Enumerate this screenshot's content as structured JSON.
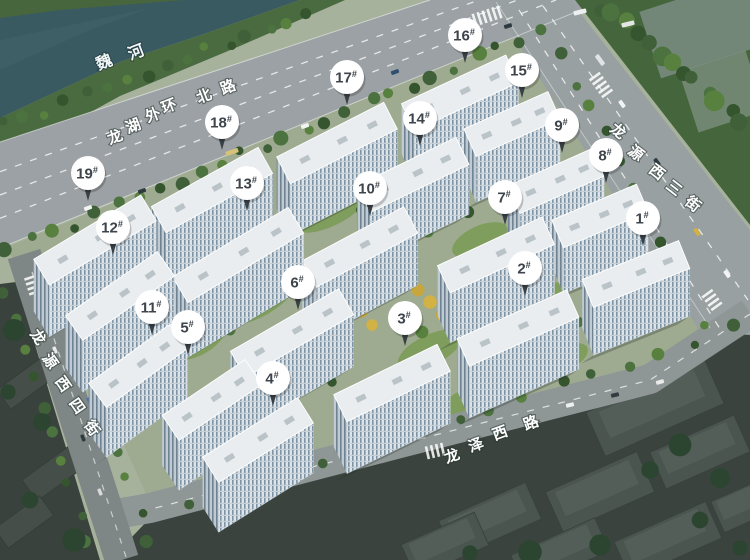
{
  "scene": {
    "type": "aerial-residential-site-plan",
    "width": 750,
    "height": 560
  },
  "palette": {
    "river": "#3a5a62",
    "road": "#9aa1a4",
    "site_ground": "#9fab91",
    "lawn": "#7c9b58",
    "tree_dark": "#3f6038",
    "tree_gold": "#d2b145",
    "building_roof": "#e9edef",
    "building_facade": "#8ea3b2",
    "marker_bg": "#ffffff",
    "marker_text": "#3d444b",
    "marker_tail": "#3a4146",
    "shadow_city": "#3a433e",
    "label_text": "#ffffff"
  },
  "river_label": {
    "name": "魏河",
    "chars": [
      {
        "t": "魏",
        "x": 104,
        "y": 62,
        "r": -21
      },
      {
        "t": "河",
        "x": 136,
        "y": 52,
        "r": -21
      }
    ]
  },
  "streets": [
    {
      "name": "龙湖外环北路",
      "chars": [
        {
          "t": "龙",
          "x": 115,
          "y": 137,
          "r": -21
        },
        {
          "t": "湖",
          "x": 133,
          "y": 126,
          "r": -21
        },
        {
          "t": "外",
          "x": 153,
          "y": 115,
          "r": -21
        },
        {
          "t": "环",
          "x": 169,
          "y": 106,
          "r": -21
        },
        {
          "t": "北",
          "x": 204,
          "y": 96,
          "r": -21
        },
        {
          "t": "路",
          "x": 228,
          "y": 87,
          "r": -21
        }
      ]
    },
    {
      "name": "龙源西三街",
      "chars": [
        {
          "t": "龙",
          "x": 618,
          "y": 131,
          "r": 38
        },
        {
          "t": "源",
          "x": 636,
          "y": 153,
          "r": 38
        },
        {
          "t": "西",
          "x": 657,
          "y": 172,
          "r": 38
        },
        {
          "t": "三",
          "x": 674,
          "y": 188,
          "r": 38
        },
        {
          "t": "街",
          "x": 693,
          "y": 204,
          "r": 38
        }
      ]
    },
    {
      "name": "龙源西四街",
      "chars": [
        {
          "t": "龙",
          "x": 38,
          "y": 337,
          "r": 55
        },
        {
          "t": "源",
          "x": 50,
          "y": 361,
          "r": 55
        },
        {
          "t": "西",
          "x": 63,
          "y": 384,
          "r": 55
        },
        {
          "t": "四",
          "x": 77,
          "y": 406,
          "r": 55
        },
        {
          "t": "街",
          "x": 92,
          "y": 428,
          "r": 55
        }
      ]
    },
    {
      "name": "龙泽西路",
      "chars": [
        {
          "t": "龙",
          "x": 452,
          "y": 456,
          "r": -20
        },
        {
          "t": "泽",
          "x": 476,
          "y": 445,
          "r": -20
        },
        {
          "t": "西",
          "x": 500,
          "y": 433,
          "r": -20
        },
        {
          "t": "路",
          "x": 531,
          "y": 423,
          "r": -20
        }
      ]
    }
  ],
  "markers": [
    {
      "id": 1,
      "label": "1",
      "suffix": "#",
      "x": 643,
      "y": 218
    },
    {
      "id": 2,
      "label": "2",
      "suffix": "#",
      "x": 525,
      "y": 268
    },
    {
      "id": 3,
      "label": "3",
      "suffix": "#",
      "x": 405,
      "y": 318
    },
    {
      "id": 4,
      "label": "4",
      "suffix": "#",
      "x": 273,
      "y": 378
    },
    {
      "id": 5,
      "label": "5",
      "suffix": "#",
      "x": 188,
      "y": 327
    },
    {
      "id": 6,
      "label": "6",
      "suffix": "#",
      "x": 298,
      "y": 282
    },
    {
      "id": 7,
      "label": "7",
      "suffix": "#",
      "x": 505,
      "y": 197
    },
    {
      "id": 8,
      "label": "8",
      "suffix": "#",
      "x": 606,
      "y": 155
    },
    {
      "id": 9,
      "label": "9",
      "suffix": "#",
      "x": 562,
      "y": 125
    },
    {
      "id": 10,
      "label": "10",
      "suffix": "#",
      "x": 370,
      "y": 188
    },
    {
      "id": 11,
      "label": "11",
      "suffix": "#",
      "x": 152,
      "y": 307
    },
    {
      "id": 12,
      "label": "12",
      "suffix": "#",
      "x": 113,
      "y": 227
    },
    {
      "id": 13,
      "label": "13",
      "suffix": "#",
      "x": 247,
      "y": 183
    },
    {
      "id": 14,
      "label": "14",
      "suffix": "#",
      "x": 420,
      "y": 118
    },
    {
      "id": 15,
      "label": "15",
      "suffix": "#",
      "x": 522,
      "y": 70
    },
    {
      "id": 16,
      "label": "16",
      "suffix": "#",
      "x": 465,
      "y": 35
    },
    {
      "id": 17,
      "label": "17",
      "suffix": "#",
      "x": 347,
      "y": 77
    },
    {
      "id": 18,
      "label": "18",
      "suffix": "#",
      "x": 222,
      "y": 122
    },
    {
      "id": 19,
      "label": "19",
      "suffix": "#",
      "x": 88,
      "y": 173
    }
  ]
}
